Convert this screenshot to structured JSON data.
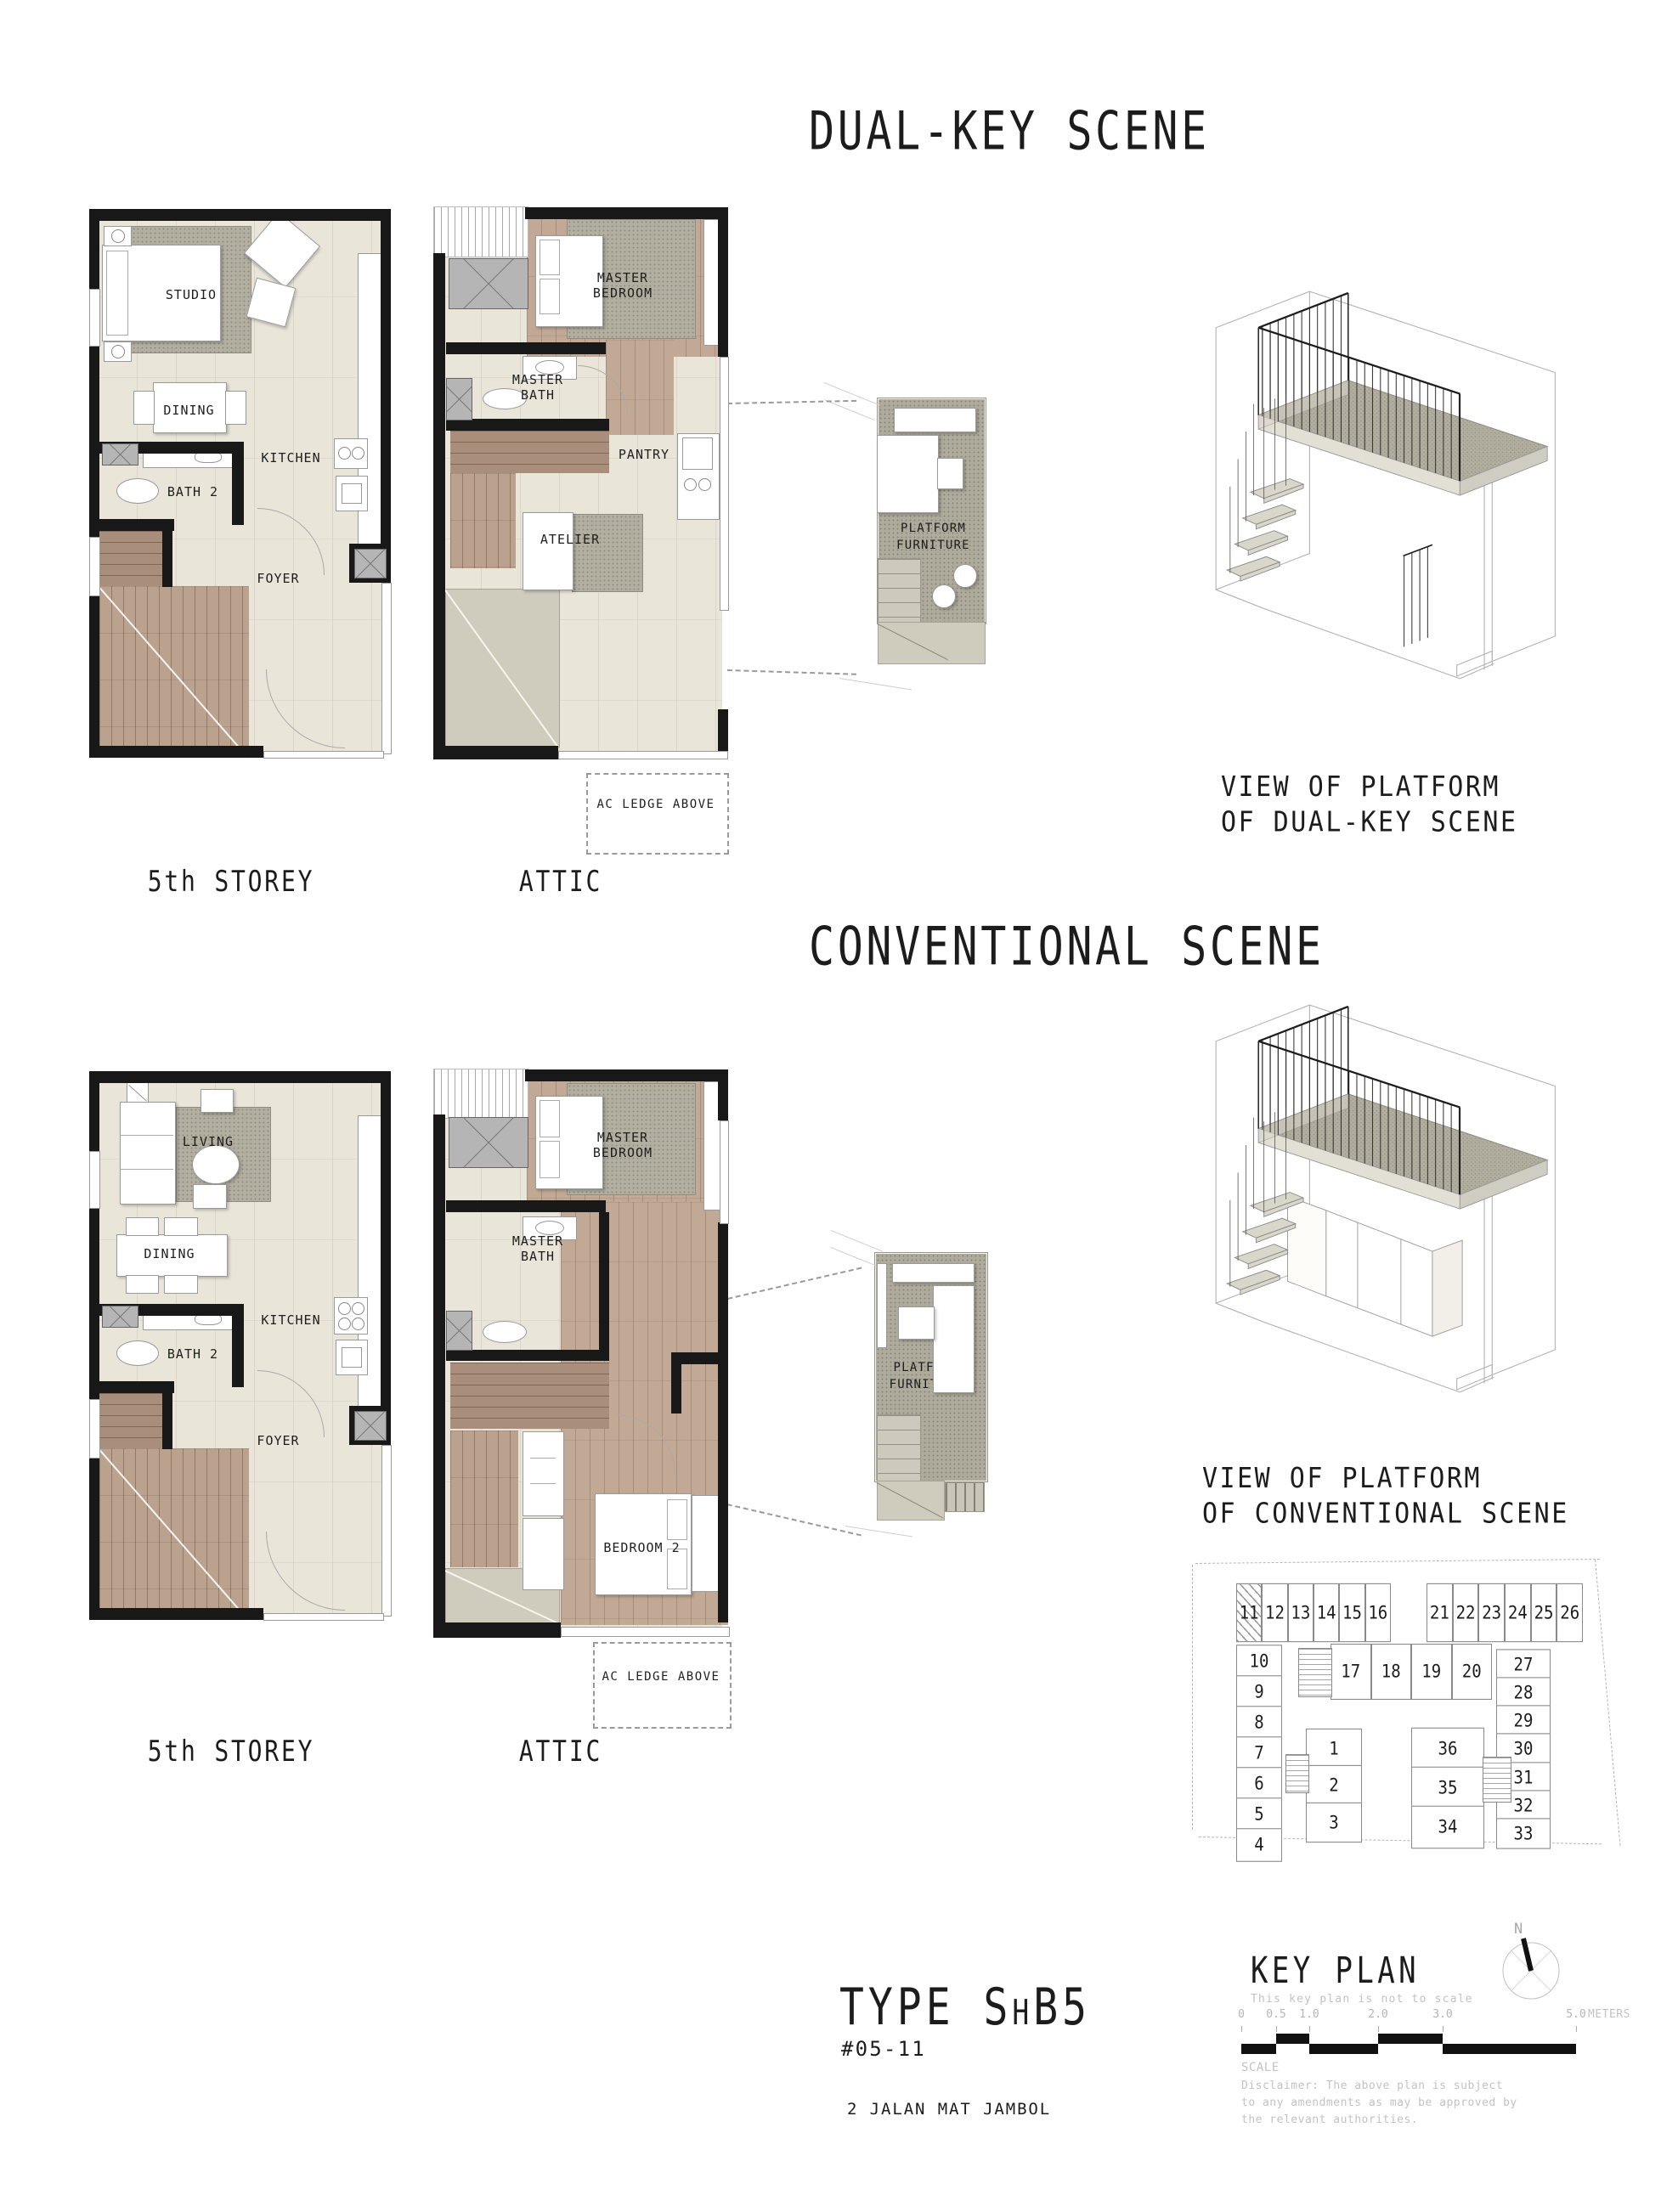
{
  "titles": {
    "dual": "DUAL-KEY SCENE",
    "conventional": "CONVENTIONAL SCENE"
  },
  "plan_labels": {
    "fifth_storey": "5th STOREY",
    "attic": "ATTIC"
  },
  "annotations": {
    "ac_ledge": "AC LEDGE ABOVE",
    "platform_furniture": "PLATFORM FURNITURE"
  },
  "rooms": {
    "studio": "STUDIO",
    "dining": "DINING",
    "kitchen": "KITCHEN",
    "bath2": "BATH 2",
    "foyer": "FOYER",
    "master_bedroom": "MASTER BEDROOM",
    "master_bath": "MASTER BATH",
    "pantry": "PANTRY",
    "atelier": "ATELIER",
    "living": "LIVING",
    "bedroom2": "BEDROOM 2"
  },
  "captions": {
    "dual_line1": "VIEW OF PLATFORM",
    "dual_line2": "OF DUAL-KEY SCENE",
    "conv_line1": "VIEW OF PLATFORM",
    "conv_line2": "OF CONVENTIONAL SCENE"
  },
  "unit": {
    "type_prefix": "TYPE S",
    "type_small": "H",
    "type_suffix": "B5",
    "number": "#05-11",
    "address": "2 JALAN MAT JAMBOL"
  },
  "keyplan": {
    "title": "KEY PLAN",
    "subtitle": "This key plan is not to scale",
    "north": "N",
    "top_left": [
      "11",
      "12",
      "13",
      "14",
      "15",
      "16"
    ],
    "top_right": [
      "21",
      "22",
      "23",
      "24",
      "25",
      "26"
    ],
    "left_col": [
      "10",
      "9",
      "8",
      "7",
      "6",
      "5",
      "4"
    ],
    "mid_row": [
      "17",
      "18",
      "19",
      "20"
    ],
    "right_col": [
      "27",
      "28",
      "29",
      "30",
      "31",
      "32",
      "33"
    ],
    "block_a": [
      "1",
      "2",
      "3"
    ],
    "block_b": [
      "36",
      "35",
      "34"
    ]
  },
  "scalebar": {
    "t0": "0",
    "t05": "0.5",
    "t10": "1.0",
    "t20": "2.0",
    "t30": "3.0",
    "t50": "5.0",
    "unit": "METERS",
    "label": "SCALE"
  },
  "disclaimer": {
    "line1": "Disclaimer: The above plan is subject",
    "line2": "to any amendments as may be approved by",
    "line3": "the relevant authorities."
  },
  "colors": {
    "wall": "#1a1a1a",
    "floor": "#eae5d9",
    "wood": "#b49c89",
    "rug": "#b2afa1",
    "speckle": "#aeab9c"
  }
}
